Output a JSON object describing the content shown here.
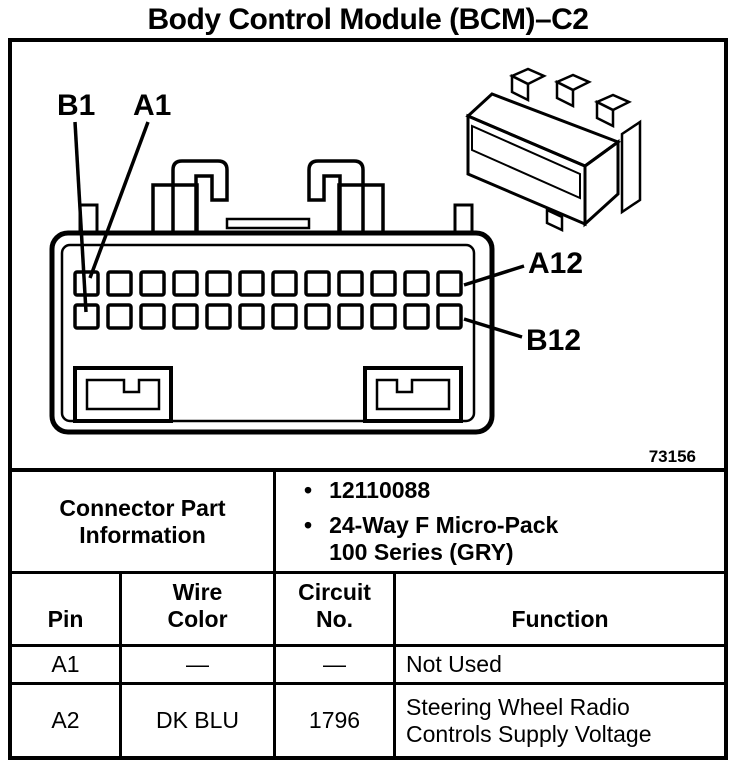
{
  "page": {
    "title": "Body Control Module (BCM)–C2"
  },
  "diagram": {
    "pin_labels": {
      "b1": "B1",
      "a1": "A1",
      "a12": "A12",
      "b12": "B12"
    },
    "figure_number": "73156",
    "pin_rows": 2,
    "pin_columns": 12
  },
  "connector_info": {
    "label": "Connector Part Information",
    "bullets": [
      "12110088",
      "24-Way F Micro-Pack 100 Series (GRY)"
    ]
  },
  "pin_table": {
    "headers": [
      "Pin",
      "Wire Color",
      "Circuit No.",
      "Function"
    ],
    "rows": [
      {
        "pin": "A1",
        "wire_color": "—",
        "circuit_no": "—",
        "function": "Not Used"
      },
      {
        "pin": "A2",
        "wire_color": "DK BLU",
        "circuit_no": "1796",
        "function": "Steering Wheel Radio Controls Supply Voltage"
      }
    ]
  }
}
